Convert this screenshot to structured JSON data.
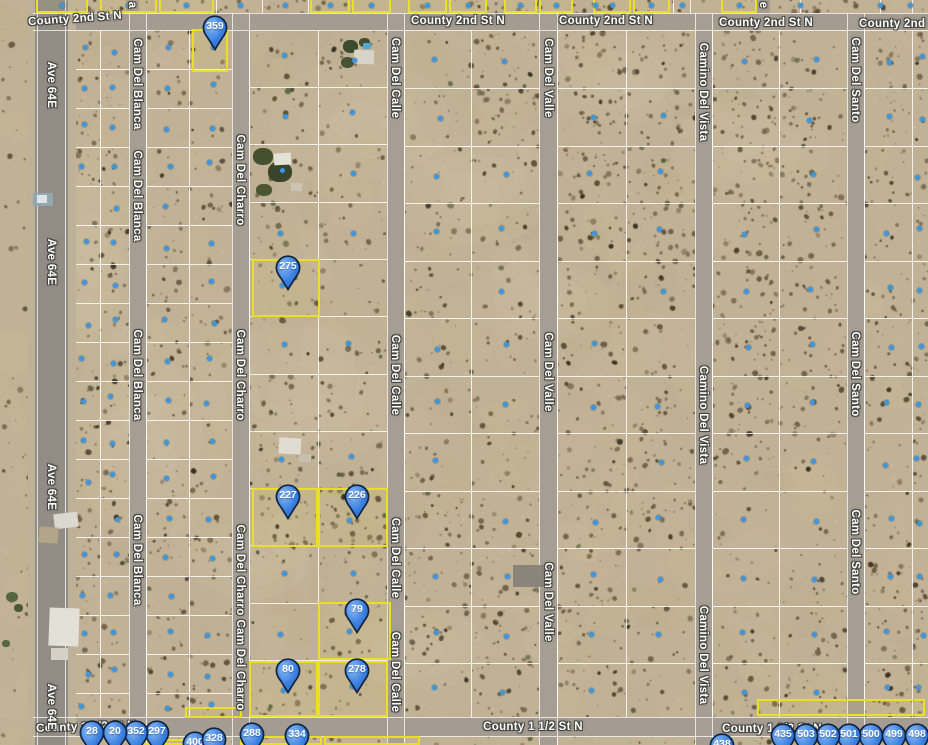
{
  "map": {
    "type": "satellite-parcel-map",
    "width": 928,
    "height": 745,
    "accent_pin_color": "#3b80e0",
    "pin_outline_color": "#10233f",
    "parcel_highlight_color": "#e9df2a",
    "parcel_dot_color": "#3e97de",
    "terrain_base_color": "#c2b295",
    "road_color": "#a49c90"
  },
  "streets": {
    "horizontal": [
      {
        "name": "County 2nd St N",
        "y": 13,
        "h": 17,
        "labels": [
          {
            "x": 75,
            "y": 19,
            "rot": -4
          },
          {
            "x": 458,
            "y": 21,
            "rot": 0
          },
          {
            "x": 606,
            "y": 21,
            "rot": 0
          },
          {
            "x": 766,
            "y": 23,
            "rot": 0
          },
          {
            "x": 906,
            "y": 24,
            "rot": 0
          }
        ]
      },
      {
        "name": "County 1 1/2 St N",
        "y": 717,
        "h": 19,
        "labels": [
          {
            "x": 86,
            "y": 727,
            "rot": -2
          },
          {
            "x": 533,
            "y": 727,
            "rot": 0
          },
          {
            "x": 772,
            "y": 729,
            "rot": 0
          }
        ]
      }
    ],
    "vertical": [
      {
        "name": "Ave 64E",
        "x": 35,
        "w": 33,
        "kind": "highway",
        "label_x": 51,
        "labels": [
          85,
          262,
          487,
          707
        ]
      },
      {
        "name": "Cam Del Blanca",
        "x": 129,
        "w": 17,
        "label_x": 137,
        "labels": [
          84,
          196,
          375,
          560
        ]
      },
      {
        "name": "Cam Del Charro",
        "x": 232,
        "w": 17,
        "label_x": 240,
        "labels": [
          180,
          375,
          570,
          665
        ]
      },
      {
        "name": "Cam Del Calle",
        "x": 387,
        "w": 17,
        "label_x": 395,
        "labels": [
          78,
          375,
          558,
          672
        ]
      },
      {
        "name": "Cam Del Valle",
        "x": 539,
        "w": 18,
        "label_x": 548,
        "labels": [
          78,
          372,
          602
        ]
      },
      {
        "name": "Camino Del Vista",
        "x": 695,
        "w": 17,
        "label_x": 703,
        "labels": [
          92,
          415,
          655
        ]
      },
      {
        "name": "Cam Del Santo",
        "x": 847,
        "w": 17,
        "label_x": 855,
        "labels": [
          80,
          374,
          552
        ]
      }
    ],
    "north_stubs": [
      {
        "x": 126,
        "w": 13
      },
      {
        "x": 757,
        "w": 13
      }
    ],
    "fragments": [
      {
        "text": "a",
        "x": 132,
        "y": 5
      },
      {
        "text": "e",
        "x": 763,
        "y": 5
      }
    ]
  },
  "pins": [
    {
      "label": "359",
      "x": 215,
      "y": 28,
      "z": 9
    },
    {
      "label": "275",
      "x": 288,
      "y": 268,
      "z": 9
    },
    {
      "label": "227",
      "x": 288,
      "y": 497,
      "z": 9
    },
    {
      "label": "226",
      "x": 357,
      "y": 497,
      "z": 9
    },
    {
      "label": "79",
      "x": 357,
      "y": 611,
      "z": 9
    },
    {
      "label": "80",
      "x": 288,
      "y": 671,
      "z": 9
    },
    {
      "label": "278",
      "x": 357,
      "y": 671,
      "z": 9
    },
    {
      "label": "28",
      "x": 92,
      "y": 733,
      "z": 16
    },
    {
      "label": "20",
      "x": 115,
      "y": 733,
      "z": 15
    },
    {
      "label": "352",
      "x": 136,
      "y": 733,
      "z": 14
    },
    {
      "label": "297",
      "x": 157,
      "y": 733,
      "z": 13
    },
    {
      "label": "400",
      "x": 195,
      "y": 744,
      "z": 10
    },
    {
      "label": "328",
      "x": 214,
      "y": 740,
      "z": 11
    },
    {
      "label": "288",
      "x": 252,
      "y": 735,
      "z": 12
    },
    {
      "label": "334",
      "x": 297,
      "y": 736,
      "z": 12
    },
    {
      "label": "438",
      "x": 722,
      "y": 746,
      "z": 10
    },
    {
      "label": "435",
      "x": 783,
      "y": 736,
      "z": 17
    },
    {
      "label": "503",
      "x": 806,
      "y": 736,
      "z": 14
    },
    {
      "label": "502",
      "x": 828,
      "y": 736,
      "z": 13
    },
    {
      "label": "501",
      "x": 849,
      "y": 736,
      "z": 12
    },
    {
      "label": "500",
      "x": 871,
      "y": 736,
      "z": 11
    },
    {
      "label": "499",
      "x": 894,
      "y": 736,
      "z": 12
    },
    {
      "label": "498",
      "x": 917,
      "y": 736,
      "z": 13
    }
  ],
  "parcels": {
    "highlighted": [
      [
        192,
        29,
        36,
        43
      ],
      [
        252,
        259,
        68,
        58
      ],
      [
        252,
        488,
        66,
        59
      ],
      [
        318,
        488,
        70,
        59
      ],
      [
        318,
        602,
        73,
        58
      ],
      [
        249,
        661,
        69,
        56
      ],
      [
        318,
        661,
        70,
        56
      ],
      [
        185,
        707,
        57,
        11
      ],
      [
        133,
        739,
        54,
        6
      ],
      [
        240,
        736,
        82,
        9
      ],
      [
        324,
        736,
        96,
        9
      ],
      [
        757,
        699,
        168,
        17
      ]
    ],
    "top_strip_highlighted": [
      [
        36,
        52
      ],
      [
        100,
        57
      ],
      [
        159,
        55
      ],
      [
        310,
        40
      ],
      [
        352,
        39
      ],
      [
        408,
        39
      ],
      [
        449,
        38
      ],
      [
        504,
        33
      ],
      [
        539,
        34
      ],
      [
        593,
        38
      ],
      [
        633,
        37
      ],
      [
        721,
        36
      ]
    ],
    "top_strip_dots_x": [
      62,
      128,
      186,
      240,
      285,
      330,
      371,
      427,
      468,
      520,
      556,
      595,
      612,
      651,
      682,
      739,
      800,
      880,
      910
    ]
  },
  "grid": {
    "columns": [
      {
        "x0": 71,
        "x1": 129,
        "split": 100,
        "rows": "A"
      },
      {
        "x0": 146,
        "x1": 232,
        "split": 189,
        "rows": "A"
      },
      {
        "x0": 249,
        "x1": 387,
        "split": 318,
        "rows": "C"
      },
      {
        "x0": 404,
        "x1": 539,
        "split": 471,
        "rows": "D"
      },
      {
        "x0": 557,
        "x1": 695,
        "split": 626,
        "rows": "D"
      },
      {
        "x0": 712,
        "x1": 847,
        "split": 779,
        "rows": "D"
      },
      {
        "x0": 864,
        "x1": 928,
        "split": 912,
        "rows": "D"
      }
    ],
    "row_lines": {
      "A": [
        69,
        108,
        147,
        186,
        225,
        264,
        303,
        342,
        381,
        420,
        459,
        498,
        537,
        576,
        615,
        654,
        693
      ],
      "C": [
        87,
        144,
        202,
        259,
        316,
        374,
        431,
        488,
        545,
        603,
        660
      ],
      "D": [
        88,
        146,
        203,
        261,
        318,
        376,
        433,
        491,
        548,
        606,
        663
      ]
    },
    "row_groups": [
      {
        "x": 71,
        "w": 161,
        "rows": "A"
      },
      {
        "x": 249,
        "w": 138,
        "rows": "C"
      },
      {
        "x": 404,
        "w": 524,
        "rows": "D"
      }
    ],
    "top_strip_vlines": [
      216,
      262,
      308,
      673,
      690,
      800,
      880,
      912
    ],
    "block_top": 30,
    "block_bottom": 717
  },
  "buildings": [
    {
      "x": 253,
      "y": 148,
      "w": 20,
      "h": 17,
      "c": "#44502f",
      "r": 0,
      "round": 45
    },
    {
      "x": 268,
      "y": 162,
      "w": 24,
      "h": 20,
      "c": "#3a4429",
      "r": 0,
      "round": 45
    },
    {
      "x": 256,
      "y": 184,
      "w": 16,
      "h": 12,
      "c": "#4c5633",
      "r": 0,
      "round": 45
    },
    {
      "x": 274,
      "y": 153,
      "w": 17,
      "h": 12,
      "c": "#e4e1d8",
      "r": -3,
      "round": 0
    },
    {
      "x": 291,
      "y": 183,
      "w": 11,
      "h": 8,
      "c": "#cbc5b8",
      "r": 2,
      "round": 0
    },
    {
      "x": 343,
      "y": 40,
      "w": 15,
      "h": 13,
      "c": "#3c4a2d",
      "r": 0,
      "round": 45
    },
    {
      "x": 341,
      "y": 57,
      "w": 13,
      "h": 11,
      "c": "#465233",
      "r": 0,
      "round": 45
    },
    {
      "x": 359,
      "y": 38,
      "w": 11,
      "h": 9,
      "c": "#424e30",
      "r": 0,
      "round": 45
    },
    {
      "x": 354,
      "y": 50,
      "w": 20,
      "h": 14,
      "c": "#d9d4c9",
      "r": 2,
      "round": 0
    },
    {
      "x": 363,
      "y": 43,
      "w": 8,
      "h": 6,
      "c": "#5aa4d4",
      "r": 0,
      "round": 20
    },
    {
      "x": 279,
      "y": 438,
      "w": 22,
      "h": 16,
      "c": "#e0dcd2",
      "r": 3,
      "round": 0
    },
    {
      "x": 299,
      "y": 454,
      "w": 12,
      "h": 8,
      "c": "#c7c0b2",
      "r": 0,
      "round": 0
    },
    {
      "x": 33,
      "y": 193,
      "w": 20,
      "h": 13,
      "c": "#93a7b0",
      "r": 0,
      "round": 0
    },
    {
      "x": 37,
      "y": 195,
      "w": 10,
      "h": 8,
      "c": "#e0e4e6",
      "r": 0,
      "round": 0
    },
    {
      "x": 54,
      "y": 513,
      "w": 24,
      "h": 15,
      "c": "#dbd8d0",
      "r": -7,
      "round": 0
    },
    {
      "x": 39,
      "y": 527,
      "w": 19,
      "h": 16,
      "c": "#b3a588",
      "r": 4,
      "round": 0
    },
    {
      "x": 49,
      "y": 608,
      "w": 30,
      "h": 38,
      "c": "#e3e0d8",
      "r": 2,
      "round": 0
    },
    {
      "x": 51,
      "y": 648,
      "w": 17,
      "h": 12,
      "c": "#d5d1c6",
      "r": 0,
      "round": 0
    },
    {
      "x": 513,
      "y": 565,
      "w": 31,
      "h": 22,
      "c": "#8a847b",
      "r": 0,
      "round": 0
    },
    {
      "x": 6,
      "y": 592,
      "w": 12,
      "h": 10,
      "c": "#55663e",
      "r": 0,
      "round": 45
    },
    {
      "x": 14,
      "y": 604,
      "w": 9,
      "h": 8,
      "c": "#4a5a36",
      "r": 0,
      "round": 45
    },
    {
      "x": 2,
      "y": 640,
      "w": 8,
      "h": 7,
      "c": "#56663f",
      "r": 0,
      "round": 45
    }
  ],
  "terrain_patches": [
    [
      300,
      396,
      100,
      70
    ],
    [
      150,
      430,
      80,
      110
    ],
    [
      360,
      120,
      90,
      60
    ],
    [
      470,
      190,
      90,
      55
    ],
    [
      620,
      80,
      80,
      45
    ],
    [
      250,
      560,
      60,
      40
    ],
    [
      90,
      250,
      50,
      120
    ],
    [
      540,
      300,
      70,
      40
    ],
    [
      750,
      150,
      80,
      50
    ],
    [
      420,
      650,
      70,
      40
    ]
  ]
}
